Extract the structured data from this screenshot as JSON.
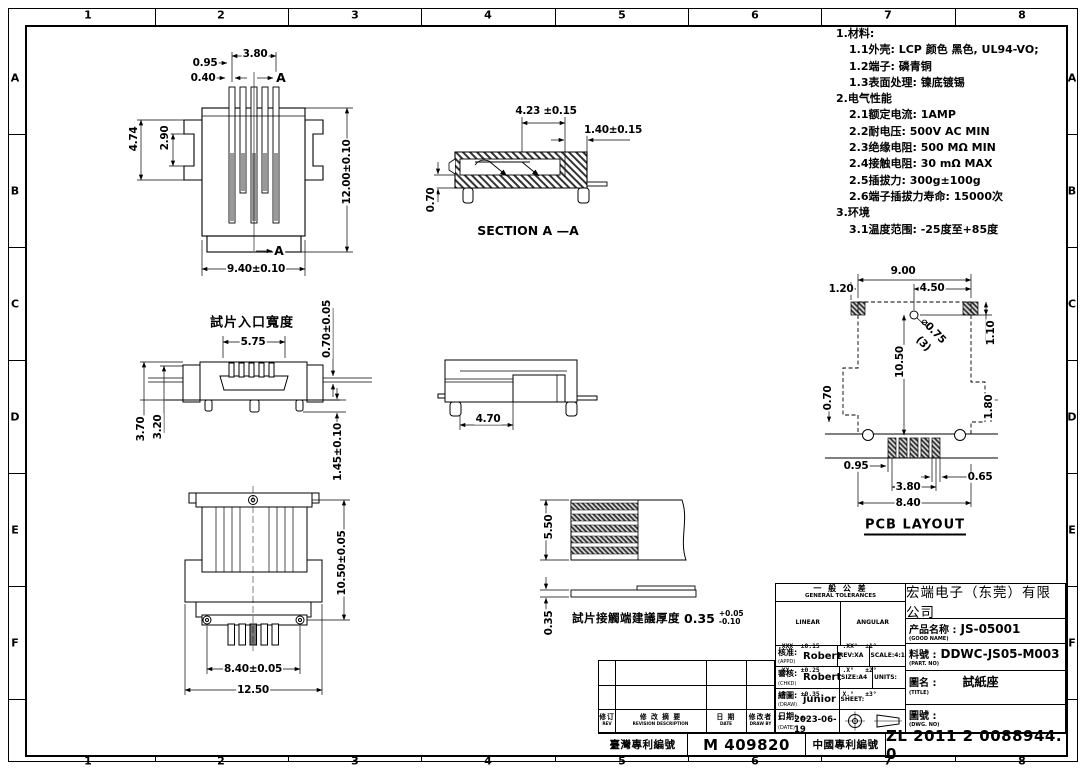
{
  "sheet": {
    "grid_cols": [
      "1",
      "2",
      "3",
      "4",
      "5",
      "6",
      "7",
      "8"
    ],
    "grid_rows": [
      "A",
      "B",
      "C",
      "D",
      "E",
      "F"
    ]
  },
  "notes": {
    "lines": [
      "1.材料:",
      "1.1外壳: LCP 颜色 黑色, UL94-VO;",
      "1.2端子: 磷青铜",
      "1.3表面处理: 镍底镀锡",
      "2.电气性能",
      "2.1额定电流: 1AMP",
      "2.2耐电压: 500V AC MIN",
      "2.3绝缘电阻: 500 MΩ  MIN",
      "2.4接触电阻: 30 mΩ  MAX",
      "2.5插拔力: 300g±100g",
      "2.6端子插拔力寿命: 15000次",
      "3.环境",
      "3.1温度范围: -25度至+85度"
    ]
  },
  "views": {
    "front": {
      "dim_total_pitch": "3.80",
      "dim_pin": "0.95",
      "dim_gap": "0.40",
      "section_mark": "A",
      "dim_wing": "4.74",
      "dim_wing_inner": "2.90",
      "dim_height": "12.00±0.10",
      "dim_width": "9.40±0.10"
    },
    "section": {
      "title": "SECTION A  —A",
      "dim_inner": "4.23 ±0.15",
      "dim_edge": "1.40±0.15",
      "dim_lip": "0.70"
    },
    "entry": {
      "label": "試片入口寬度",
      "dim_opening": "5.75",
      "dim_slot_h": "0.70±0.05",
      "dim_total_h": "3.70",
      "dim_body_h": "3.20",
      "dim_leg": "1.45±0.10"
    },
    "side": {
      "dim_length": "4.70"
    },
    "pcb": {
      "title": "PCB LAYOUT",
      "dim_width": "9.00",
      "dim_pad_inset": "1.20",
      "dim_hole_x": "4.50",
      "dim_hole_y": "1.10",
      "dim_length": "10.50",
      "dim_notch": "0.70",
      "dim_tab": "1.80",
      "hole_dia": "⌀0.75",
      "hole_qty": "(3)",
      "dim_pad_offset": "0.95",
      "dim_pad_gap": "0.65",
      "dim_pad_span": "3.80",
      "dim_pad_total": "8.40"
    },
    "bottom": {
      "dim_height": "10.50±0.05",
      "dim_screw_span": "8.40±0.05",
      "dim_width": "12.50"
    },
    "strip": {
      "dim_width": "5.50",
      "dim_thickness": "0.35",
      "caption": "試片接觸端建議厚度",
      "caption_value": "0.35",
      "caption_tol_plus": "+0.05",
      "caption_tol_minus": "-0.10"
    }
  },
  "titleblock": {
    "company": "宏端电子（东莞）有限公司",
    "tol_title_cn": "一 般 公 差",
    "tol_title_en": "GENERAL TOLERANCES",
    "linear_label": "LINEAR",
    "angular_label": "ANGULAR",
    "linear_rows": [
      ".XXX  ±0.15",
      ".XX   ±0.25",
      ".X    ±0.35",
      "X.    ±—"
    ],
    "angular_rows": [
      ".XX°  ±1°",
      ".X°   ±2°",
      "X.°   ±3°"
    ],
    "appd_label": "核准:",
    "appd_sub": "(APPD)",
    "appd_value": "Robert",
    "chkd_label": "審核:",
    "chkd_sub": "(CHKD)",
    "chkd_value": "Robert",
    "draw_label": "繪圖:",
    "draw_sub": "(DRAW)",
    "draw_value": "junior",
    "date_label": "日期:",
    "date_sub": "(DATE)",
    "date_value": "2023-06-19",
    "rev": "REV:XA",
    "scale": "SCALE:4:1",
    "size": "SIZE:A4",
    "units": "UNITS:",
    "sheet_label": "SHEET:",
    "product_label": "产品名称 :",
    "product_value": "JS-05001",
    "product_sub": "(GOOD NAME)",
    "part_label": "料號 :",
    "part_value": "DDWC-JS05-M003",
    "part_sub": "(PART. NO)",
    "name_label": "圖名 :",
    "name_value": "試紙座",
    "name_sub": "(TITLE)",
    "dwg_label": "圖號 :",
    "dwg_sub": "(DWG. NO)"
  },
  "revision": {
    "rev_cn": "修订",
    "rev_en": "REV",
    "desc_cn": "修 改 摘 要",
    "desc_en": "REVISION DESCRIPTION",
    "date_cn": "日 期",
    "date_en": "DATE",
    "by_cn": "修改者",
    "by_en": "DRAW BY"
  },
  "patents": {
    "tw_label": "臺灣專利編號",
    "tw_value": "M 409820",
    "cn_label": "中國專利編號",
    "cn_value": "ZL 2011 2 0088944. 0"
  }
}
